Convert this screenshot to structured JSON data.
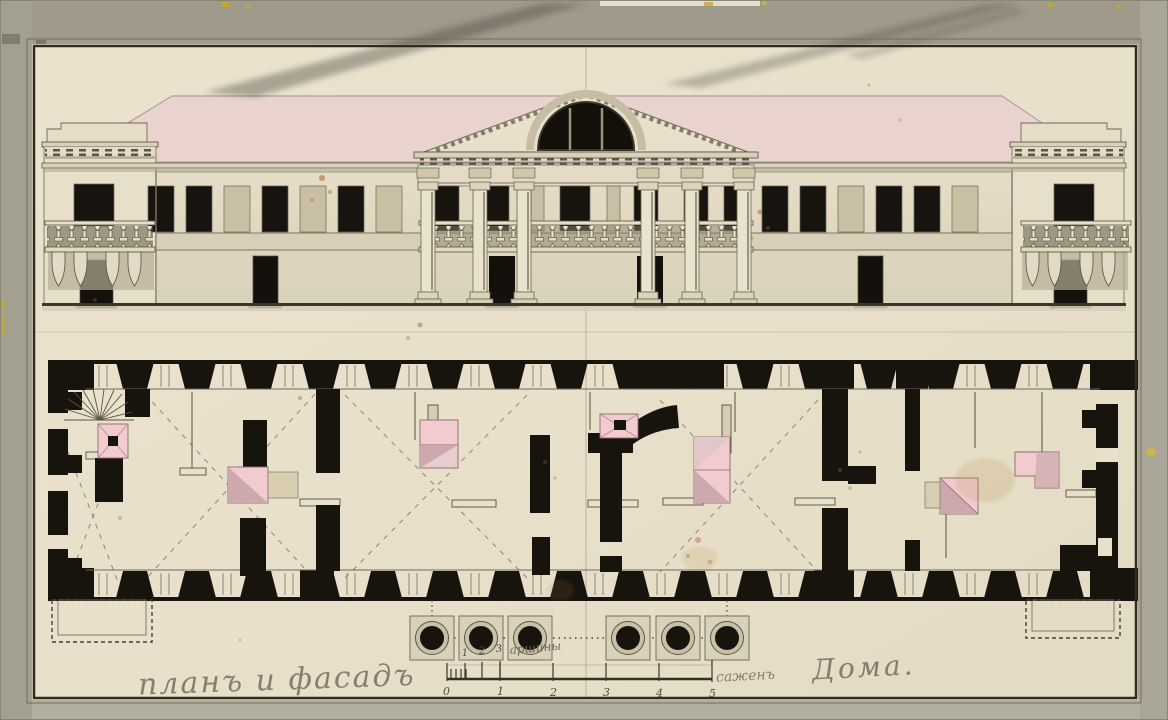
{
  "artwork": {
    "inscriptions": {
      "bottom_left": "планъ и фасадъ",
      "arshin_label": "аршины",
      "sazhen_label": "саженъ",
      "bottom_right": "Дома."
    },
    "scale_bar": {
      "arshin_ticks": [
        "1",
        "2",
        "3"
      ],
      "sazhen_ticks": [
        "0",
        "1",
        "2",
        "3",
        "4",
        "5"
      ]
    },
    "palette": {
      "mount_gray": "#a7a294",
      "paper_cream": "#e8e0ca",
      "ink_black": "#17140e",
      "roof_pink": "#ead3cf",
      "stove_pink": "#f1cbce",
      "stove_shadow_pink": "#cba9ad",
      "wall_wash": "#e2dac4",
      "pencil_gray": "#6e6659",
      "foxing_brown": "#9e5b28"
    }
  }
}
